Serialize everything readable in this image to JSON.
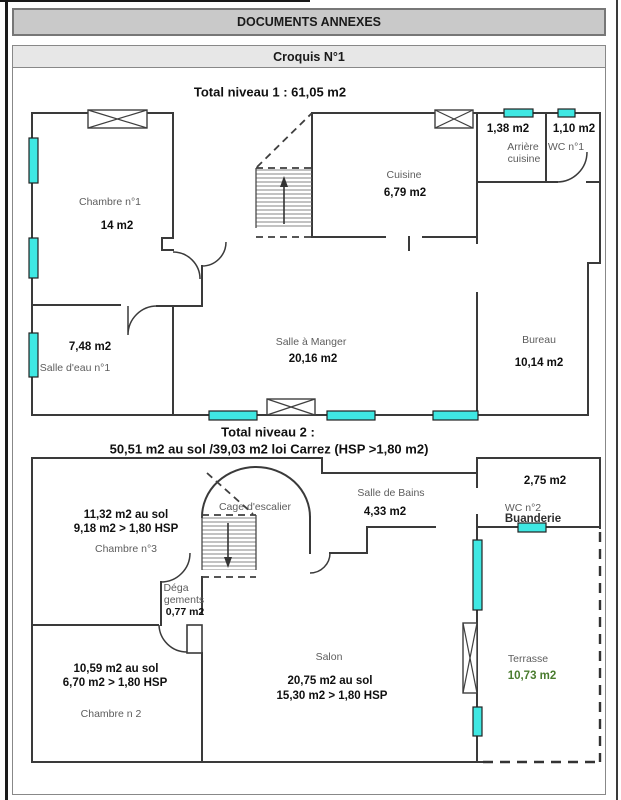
{
  "page": {
    "header_bar": "DOCUMENTS ANNEXES",
    "croquis_bar": "Croquis N°1"
  },
  "level1": {
    "title": "Total niveau 1 : 61,05 m2",
    "rooms": {
      "chambre1": {
        "name": "Chambre n°1",
        "area": "14 m2"
      },
      "cuisine": {
        "name": "Cuisine",
        "area": "6,79 m2"
      },
      "arriere_cuisine": {
        "name_line1": "Arrière",
        "name_line2": "cuisine",
        "area": "1,38 m2"
      },
      "wc1": {
        "name": "WC n°1",
        "area": "1,10 m2"
      },
      "salle_eau": {
        "name": "Salle d'eau n°1",
        "area": "7,48 m2"
      },
      "salle_a_manger": {
        "name": "Salle à Manger",
        "area": "20,16 m2"
      },
      "bureau": {
        "name": "Bureau",
        "area": "10,14 m2"
      }
    }
  },
  "level2": {
    "title_line1": "Total niveau 2 :",
    "title_line2": "50,51 m2 au sol /39,03 m2 loi Carrez (HSP >1,80 m2)",
    "rooms": {
      "chambre3": {
        "area_sol": "11,32 m2 au sol",
        "area_hsp": "9,18 m2 > 1,80 HSP",
        "name": "Chambre n°3"
      },
      "cage_escalier": {
        "name": "Cage d'escalier"
      },
      "salle_de_bains": {
        "name": "Salle de Bains",
        "area": "4,33 m2"
      },
      "wc2": {
        "name": "WC n°2",
        "area": "2,75 m2"
      },
      "buanderie": {
        "name": "Buanderie"
      },
      "degagements": {
        "name_line1": "Déga",
        "name_line2": "gements",
        "area": "0,77 m2"
      },
      "chambre2": {
        "area_sol": "10,59 m2 au sol",
        "area_hsp": "6,70 m2 > 1,80 HSP",
        "name": "Chambre n 2"
      },
      "salon": {
        "name": "Salon",
        "area_sol": "20,75 m2 au sol",
        "area_hsp": "15,30 m2 > 1,80 HSP"
      },
      "terrasse": {
        "name": "Terrasse",
        "area": "10,73 m2"
      }
    }
  },
  "colors": {
    "window_fill": "#3FE8E3",
    "wall": "#3a3a3a",
    "terrace_area_text": "#4a7c2f",
    "header1_bg": "#c9c9c9",
    "header2_bg": "#e7e7e7"
  }
}
